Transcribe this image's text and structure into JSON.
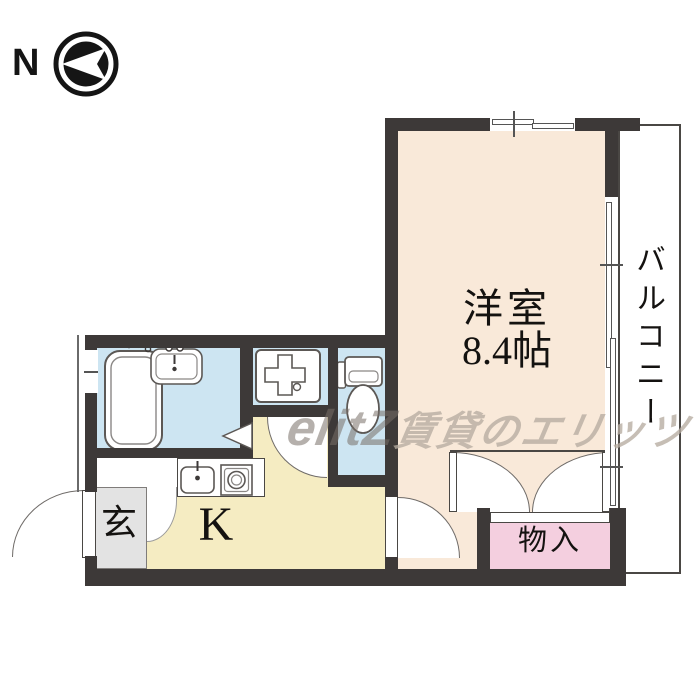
{
  "floorplan": {
    "compass": {
      "label": "N",
      "arrow_direction": "left"
    },
    "rooms": {
      "main": {
        "label": "洋室",
        "size": "8.4帖",
        "fill": "#f9e9d9"
      },
      "kitchen": {
        "label": "K",
        "fill": "#f5ecc2"
      },
      "entrance": {
        "label": "玄",
        "fill": "#e3e3e3"
      },
      "storage": {
        "label": "物入",
        "fill": "#f4cfdf"
      },
      "balcony": {
        "label": "バルコニー",
        "fill": "#ffffff"
      },
      "bathroom": {
        "fill": "#cde5f2"
      },
      "toilet_room": {
        "fill": "#cde5f2"
      },
      "laundry_nook": {
        "fill": "#cde5f2"
      }
    },
    "fixtures": [
      "bathtub",
      "washbasin",
      "washing-machine-pan",
      "toilet",
      "kitchen-sink",
      "gas-stove"
    ],
    "watermark": {
      "logo": "elitZ",
      "text": "賃貸のエリッツ"
    },
    "wall_color": "#3d3938"
  }
}
